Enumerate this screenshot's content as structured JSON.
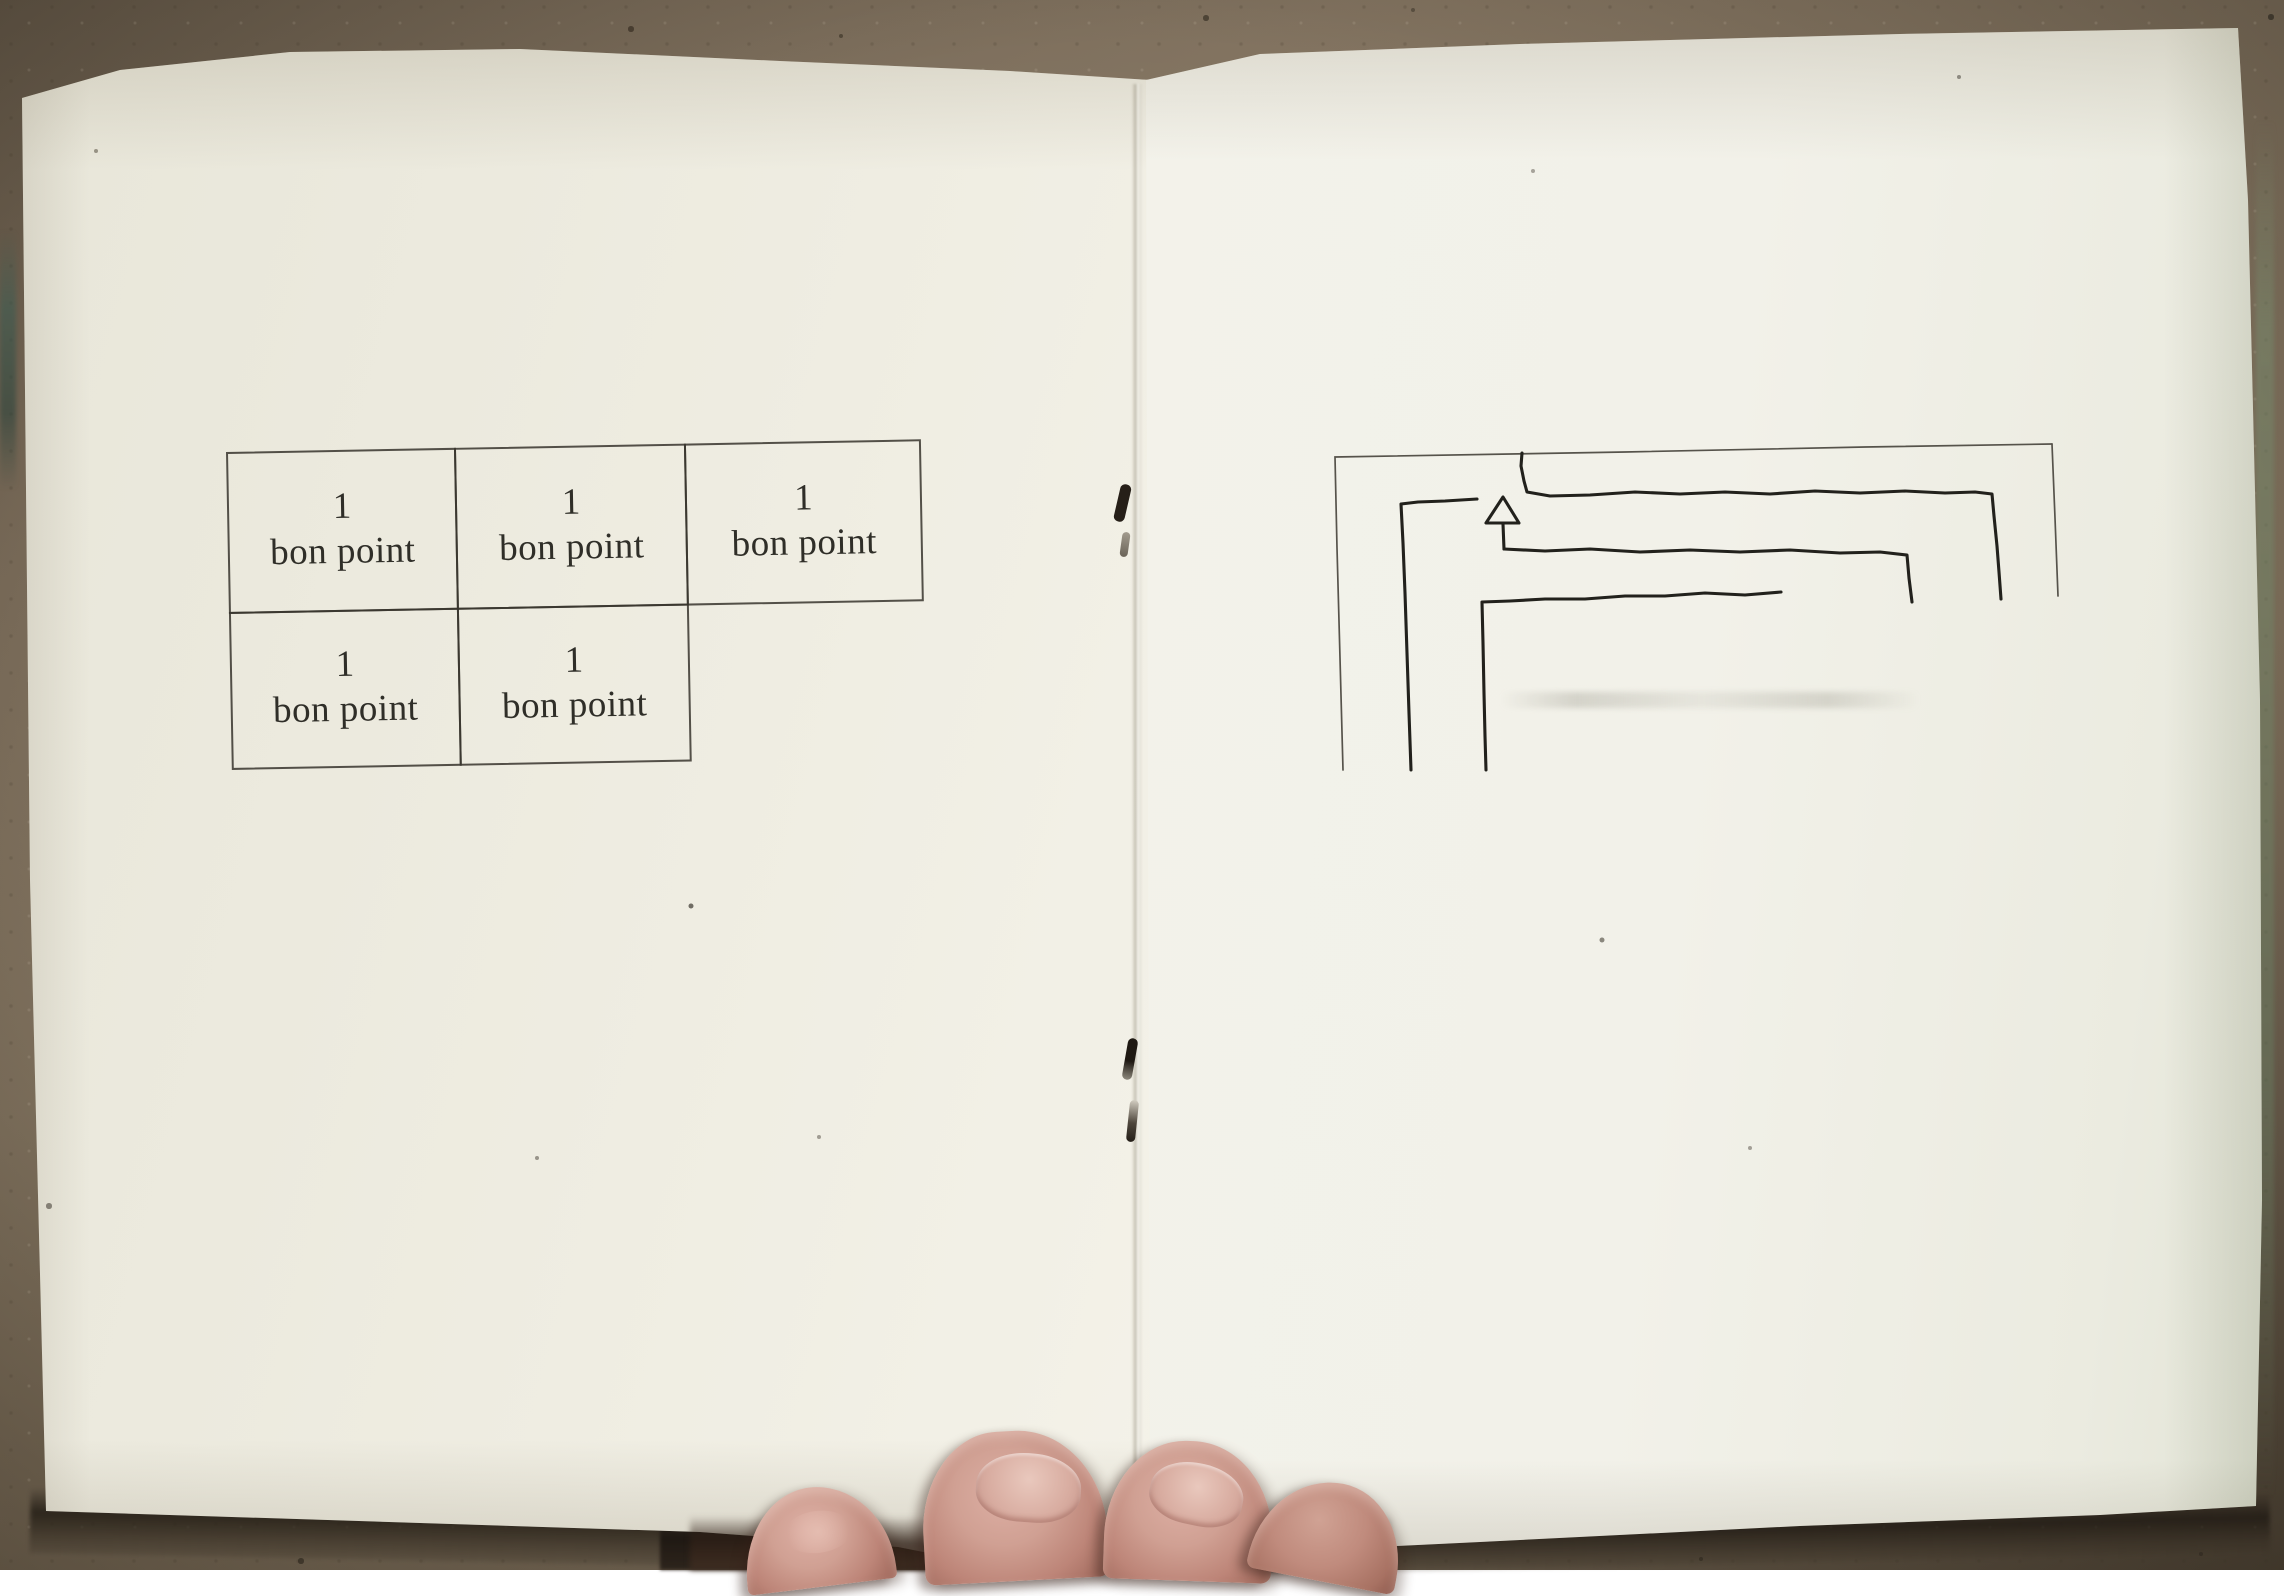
{
  "scene": {
    "description": "Photograph of an open stapled booklet lying on a brown chipboard surface, held at the bottom by four fingertips"
  },
  "left_page": {
    "table": {
      "rows": [
        {
          "cells": [
            {
              "value": "1",
              "label": "bon point"
            },
            {
              "value": "1",
              "label": "bon point"
            },
            {
              "value": "1",
              "label": "bon point"
            }
          ]
        },
        {
          "cells": [
            {
              "value": "1",
              "label": "bon point"
            },
            {
              "value": "1",
              "label": "bon point"
            }
          ]
        }
      ]
    }
  },
  "right_page": {
    "drawing": {
      "type": "hand-drawn nested maze path inside a thin printed corner border",
      "arrow_direction": "up"
    }
  },
  "colors": {
    "surface_brown": "#83745f",
    "paper_cream": "#f3f1ea",
    "hand_ink": "#22211c",
    "printed_border": "#56534b",
    "table_line": "#39362d",
    "skin": "#cf9a8d"
  }
}
